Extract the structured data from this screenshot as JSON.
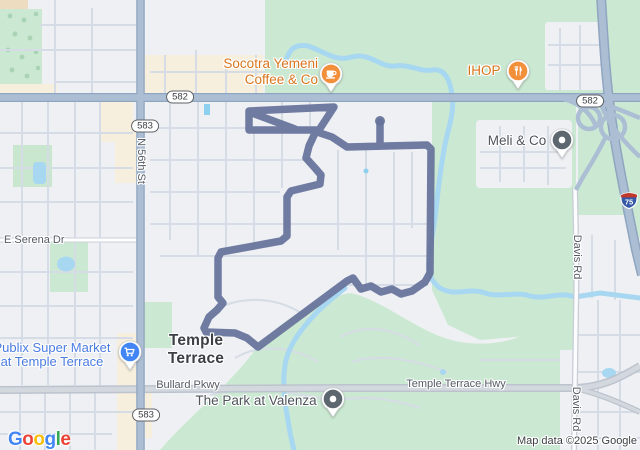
{
  "poi": {
    "socotra": {
      "line1": "Socotra Yemeni",
      "line2": "Coffee & Co"
    },
    "ihop": {
      "label": "IHOP"
    },
    "meli": {
      "label": "Meli & Co"
    },
    "publix": {
      "line1": "Publix Super Market",
      "line2": "at Temple Terrace"
    },
    "valenza": {
      "label": "The Park at Valenza"
    }
  },
  "city": {
    "line1": "Temple",
    "line2": "Terrace"
  },
  "roads": {
    "n56": "N 56th St",
    "serena": "E Serena Dr",
    "bullard": "Bullard Pkwy",
    "tthwy": "Temple Terrace Hwy",
    "davis": "Davis Rd"
  },
  "shields": {
    "sr582": "582",
    "sr583": "583",
    "i75": "75"
  },
  "attribution": {
    "text": "Map data ©2025 Google"
  },
  "logo": {
    "text": "Google",
    "letters": [
      [
        "G",
        "#4285F4"
      ],
      [
        "o",
        "#EA4335"
      ],
      [
        "o",
        "#FBBC05"
      ],
      [
        "g",
        "#4285F4"
      ],
      [
        "l",
        "#34A853"
      ],
      [
        "e",
        "#EA4335"
      ]
    ]
  },
  "colors": {
    "route": "#66729a",
    "water": "#a7d7f1",
    "park": "#cbe9d2",
    "major_road": "#abbed4",
    "highway_gray": "#d3d8df",
    "commercial": "#f6efde",
    "poi_orange_text": "#d9751d",
    "poi_blue_text": "#4a7ce0",
    "pin_orange": "#f28f3b",
    "pin_blue": "#4285f4",
    "pin_gray": "#5d676f"
  }
}
